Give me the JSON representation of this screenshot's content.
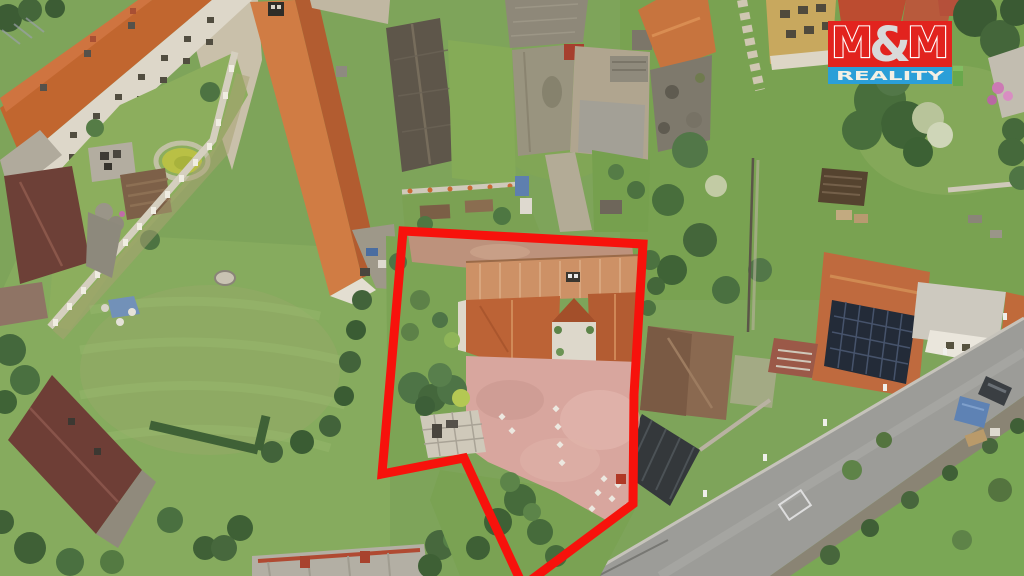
{
  "logo": {
    "m_left": "M",
    "ampersand": "&",
    "m_right": "M",
    "subtitle": "REALITY",
    "red": "#e2231e",
    "blue": "#2b9fd8",
    "amp_gray": "#d9d9d9",
    "text_cream": "#f3f0e5"
  },
  "outline": {
    "color": "#f7120c",
    "stroke_width": "9",
    "points": "403,231 643,244 634,395 633,504 523,586 464,458 382,474"
  }
}
